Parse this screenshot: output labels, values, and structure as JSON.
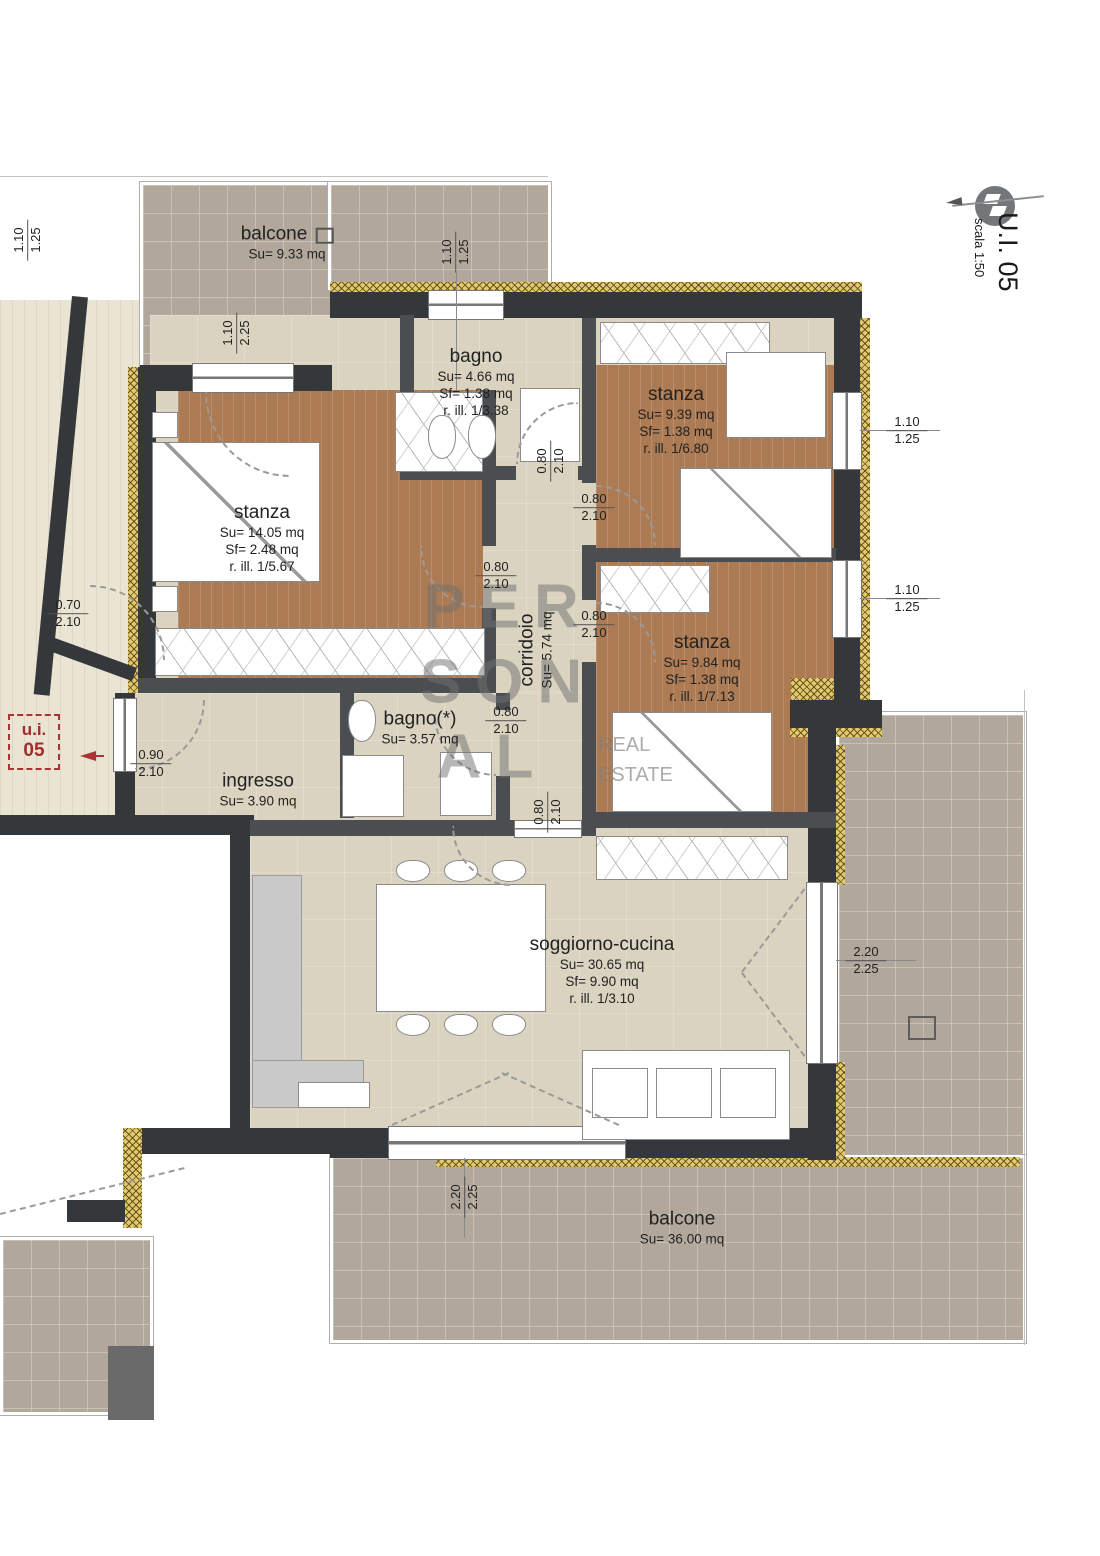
{
  "title": {
    "unit": "U.I. 05",
    "scale": "scala 1:50"
  },
  "unit_tag": {
    "line1": "u.i.",
    "line2": "05"
  },
  "watermark": {
    "l1": "PER",
    "l2": "SON",
    "l3": "AL",
    "sub1": "REAL",
    "sub2": "ESTATE"
  },
  "rooms": [
    {
      "name": "balcone",
      "su": "Su= 9.33 mq"
    },
    {
      "name": "bagno",
      "su": "Su= 4.66 mq",
      "sf": "Sf= 1.38 mq",
      "rill": "r. ill. 1/3.38"
    },
    {
      "name": "stanza",
      "su": "Su= 9.39 mq",
      "sf": "Sf= 1.38 mq",
      "rill": "r. ill. 1/6.80"
    },
    {
      "name": "stanza",
      "su": "Su= 14.05 mq",
      "sf": "Sf= 2.48 mq",
      "rill": "r. ill. 1/5.67"
    },
    {
      "name": "corridoio",
      "su": "Su= 5.74 mq"
    },
    {
      "name": "stanza",
      "su": "Su= 9.84 mq",
      "sf": "Sf= 1.38 mq",
      "rill": "r. ill. 1/7.13"
    },
    {
      "name": "bagno(*)",
      "su": "Su= 3.57 mq"
    },
    {
      "name": "ingresso",
      "su": "Su= 3.90 mq"
    },
    {
      "name": "soggiorno-cucina",
      "su": "Su= 30.65 mq",
      "sf": "Sf= 9.90 mq",
      "rill": "r. ill. 1/3.10"
    },
    {
      "name": "balcone",
      "su": "Su= 36.00 mq"
    }
  ],
  "dims": [
    {
      "top": "1.10",
      "bottom": "1.25"
    },
    {
      "top": "1.10",
      "bottom": "2.25"
    },
    {
      "top": "1.10",
      "bottom": "1.25"
    },
    {
      "top": "1.10",
      "bottom": "1.25"
    },
    {
      "top": "1.10",
      "bottom": "1.25"
    },
    {
      "top": "0.80",
      "bottom": "2.10"
    },
    {
      "top": "0.80",
      "bottom": "2.10"
    },
    {
      "top": "0.80",
      "bottom": "2.10"
    },
    {
      "top": "0.80",
      "bottom": "2.10"
    },
    {
      "top": "0.80",
      "bottom": "2.10"
    },
    {
      "top": "0.80",
      "bottom": "2.10"
    },
    {
      "top": "0.90",
      "bottom": "2.10"
    },
    {
      "top": "0.70",
      "bottom": "2.10"
    },
    {
      "top": "2.20",
      "bottom": "2.25"
    },
    {
      "top": "2.20",
      "bottom": "2.25"
    }
  ],
  "colors": {
    "wall": "#34383b",
    "partition": "#4a4e51",
    "insulation": "#e2c96e",
    "floor_interior": "#d9d3c0",
    "floor_bedroom": "#ac7a53",
    "floor_balcony": "#b1a79b",
    "accent_red": "#a93434"
  }
}
